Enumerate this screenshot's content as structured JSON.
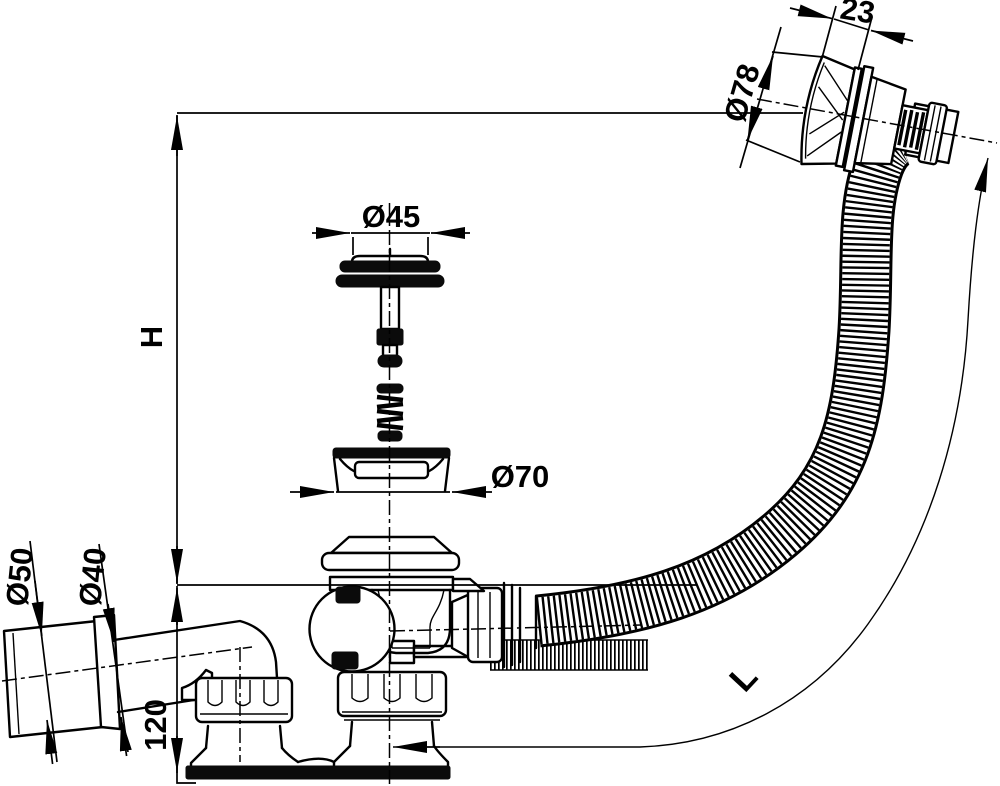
{
  "drawing": {
    "title": "bath waste and overflow drain assembly - technical drawing",
    "background_color": "#ffffff",
    "line_color": "#000000",
    "labels": {
      "install_height": "H",
      "hose_length": "L",
      "base_height": "120",
      "cap_depth": "23",
      "overflow_cap_diameter": "Ø78",
      "plug_diameter": "Ø45",
      "flange_diameter": "Ø70",
      "outlet_outer_diameter": "Ø50",
      "outlet_inner_diameter": "Ø40"
    }
  }
}
